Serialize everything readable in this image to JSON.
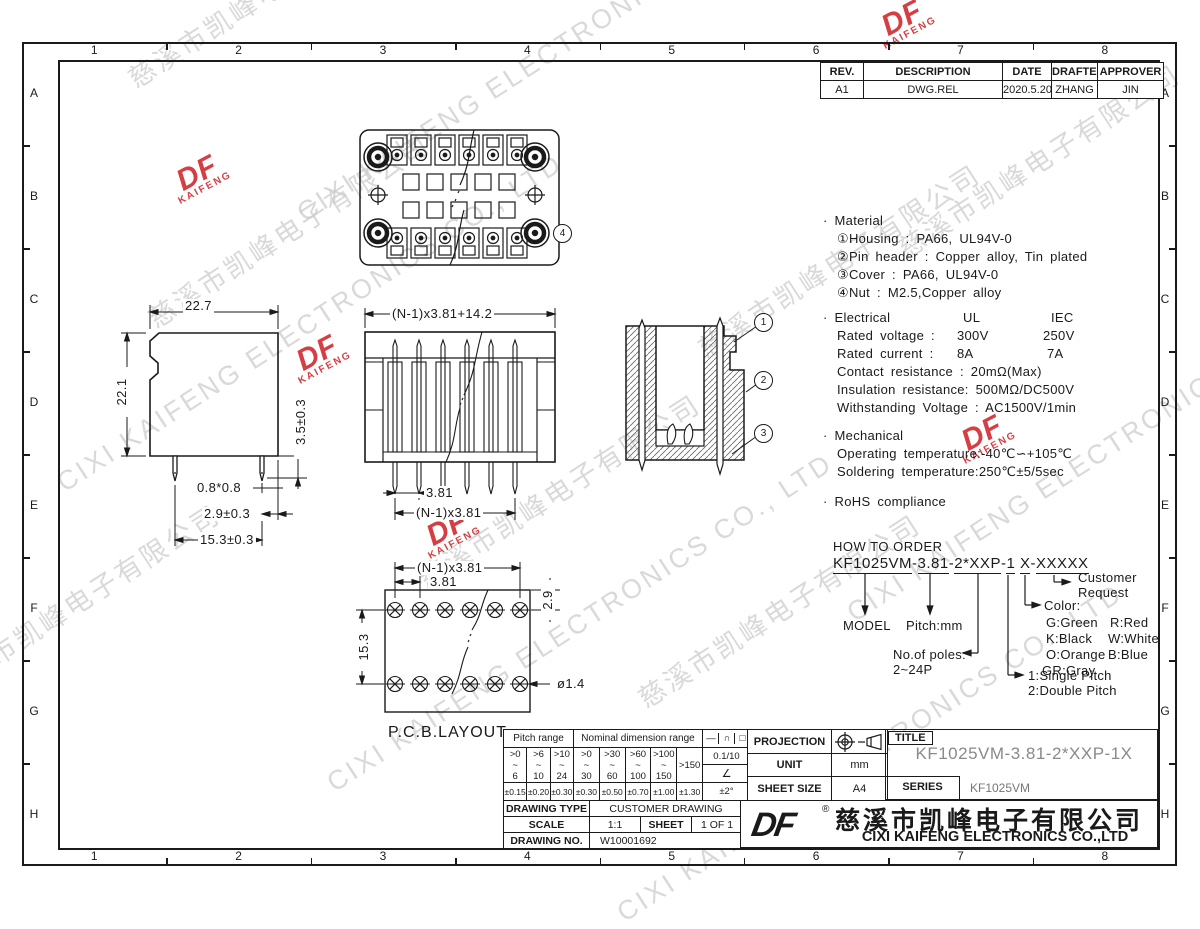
{
  "frame": {
    "cols": [
      "1",
      "2",
      "3",
      "4",
      "5",
      "6",
      "7",
      "8"
    ],
    "rows": [
      "A",
      "B",
      "C",
      "D",
      "E",
      "F",
      "G",
      "H"
    ]
  },
  "revision": {
    "headers": [
      "REV.",
      "DESCRIPTION",
      "DATE",
      "DRAFTER",
      "APPROVER"
    ],
    "row": [
      "A1",
      "DWG.REL",
      "2020.5.20",
      "ZHANG",
      "JIN"
    ]
  },
  "notes": {
    "material": {
      "title": "· Material",
      "l1": "①Housing : PA66, UL94V-0",
      "l2": "②Pin header : Copper alloy, Tin plated",
      "l3": "③Cover : PA66, UL94V-0",
      "l4": "④Nut : M2.5,Copper alloy"
    },
    "electrical": {
      "title": "· Electrical",
      "ul": "UL",
      "iec": "IEC",
      "r1l": "Rated voltage :",
      "r1ul": "300V",
      "r1iec": "250V",
      "r2l": "Rated current :",
      "r2ul": "8A",
      "r2iec": "7A",
      "r3": "Contact resistance : 20mΩ(Max)",
      "r4": "Insulation resistance: 500MΩ/DC500V",
      "r5": "Withstanding Voltage : AC1500V/1min"
    },
    "mechanical": {
      "title": "· Mechanical",
      "l1": "Operating temperature:-40℃∽+105℃",
      "l2": "Soldering temperature:250℃±5/5sec"
    },
    "rohs": "· RoHS compliance"
  },
  "order": {
    "title": "HOW TO ORDER",
    "seg1": "KF1025VM",
    "seg2": "3.81",
    "seg3": "2*XXP",
    "seg4": "1",
    "seg5": "X",
    "seg6": "XXXXX",
    "dash": "-",
    "model": "MODEL",
    "pitch": "Pitch:mm",
    "poles1": "No.of poles:",
    "poles2": "2~24P",
    "sp1": "1:Single Pitch",
    "sp2": "2:Double Pitch",
    "color_title": "Color:",
    "c1": "G:Green",
    "c2": "R:Red",
    "c3": "K:Black",
    "c4": "W:White",
    "c5": "O:Orange",
    "c6": "B:Blue",
    "c7": "GR:Gray",
    "cust1": "Customer",
    "cust2": "Request"
  },
  "dims": {
    "side": {
      "w": "22.7",
      "h": "22.1",
      "pin_h": "3.5±0.3",
      "pin_sq": "0.8*0.8",
      "pin_off": "2.9±0.3",
      "total": "15.3±0.3"
    },
    "front": {
      "total": "(N-1)x3.81+14.2",
      "pitch": "3.81",
      "span": "(N-1)x3.81"
    },
    "pcb": {
      "span": "(N-1)x3.81",
      "pitch": "3.81",
      "row": "15.3",
      "off": "2.9",
      "hole": "ø1.4",
      "label": "P.C.B.LAYOUT"
    },
    "callouts": {
      "c1": "1",
      "c2": "2",
      "c3": "3",
      "c4": "4"
    }
  },
  "tol_table": {
    "pitch_header": "Pitch range",
    "nominal_header": "Nominal dimension range",
    "sym1": "—",
    "sym2": "∩",
    "sym3": "□",
    "tilde": "~",
    "ranges": [
      {
        "a": ">0",
        "b": "6"
      },
      {
        "a": ">6",
        "b": "10"
      },
      {
        "a": ">10",
        "b": "24"
      },
      {
        "a": ">0",
        "b": "30"
      },
      {
        "a": ">30",
        "b": "60"
      },
      {
        "a": ">60",
        "b": "100"
      },
      {
        "a": ">100",
        "b": "150"
      }
    ],
    "last_range": ">150",
    "flat": "0.1/10",
    "angle": "∠",
    "tols": [
      "±0.15",
      "±0.20",
      "±0.30",
      "±0.30",
      "±0.50",
      "±0.70",
      "±1.00",
      "±1.30"
    ],
    "angle_tol": "±2°"
  },
  "proj_table": {
    "projection": "PROJECTION",
    "unit_label": "UNIT",
    "unit": "mm",
    "sheet_size_label": "SHEET SIZE",
    "sheet_size": "A4"
  },
  "title_block": {
    "title_label": "TITLE",
    "title": "KF1025VM-3.81-2*XXP-1X",
    "series_label": "SERIES",
    "series": "KF1025VM"
  },
  "drawing_table": {
    "type_label": "DRAWING TYPE",
    "type": "CUSTOMER DRAWING",
    "scale_label": "SCALE",
    "scale": "1:1",
    "sheet_label": "SHEET",
    "sheet": "1 OF 1",
    "no_label": "DRAWING NO.",
    "no": "W10001692"
  },
  "company": {
    "logo": "DF",
    "reg": "®",
    "cn": "慈溪市凯峰电子有限公司",
    "en": "CIXI KAIFENG ELECTRONICS CO.,LTD"
  },
  "watermark": {
    "cn": "慈溪市凯峰电子有限公司",
    "en": "CIXI KAIFENG ELECTRONICS CO., LTD",
    "logo_top": "DF",
    "logo_bottom": "KAIFENG"
  }
}
